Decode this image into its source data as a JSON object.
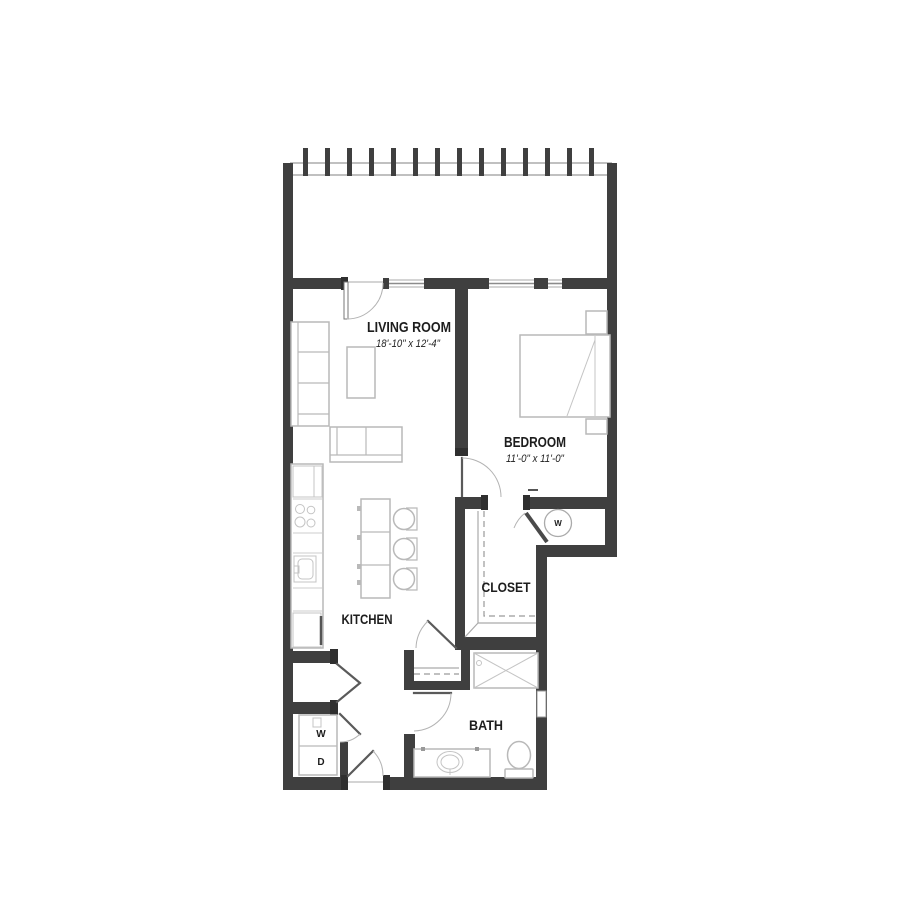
{
  "plan": {
    "type": "apartment-floor-plan",
    "rooms": {
      "living": {
        "label": "LIVING ROOM",
        "dims": "18'-10\" x 12'-4\""
      },
      "bedroom": {
        "label": "BEDROOM",
        "dims": "11'-0\" x 11'-0\""
      },
      "closet": {
        "label": "CLOSET"
      },
      "kitchen": {
        "label": "KITCHEN"
      },
      "bath": {
        "label": "BATH"
      }
    },
    "fixtures": {
      "washer": "W",
      "dryer": "D",
      "water_heater": "W"
    },
    "colors": {
      "wall": "#3f3f3f",
      "furniture_line": "#b9b9b9",
      "door_leaf": "#5a5a5a",
      "swing_arc": "#b3b3b3",
      "text": "#1d1d1d",
      "background": "#ffffff"
    }
  }
}
